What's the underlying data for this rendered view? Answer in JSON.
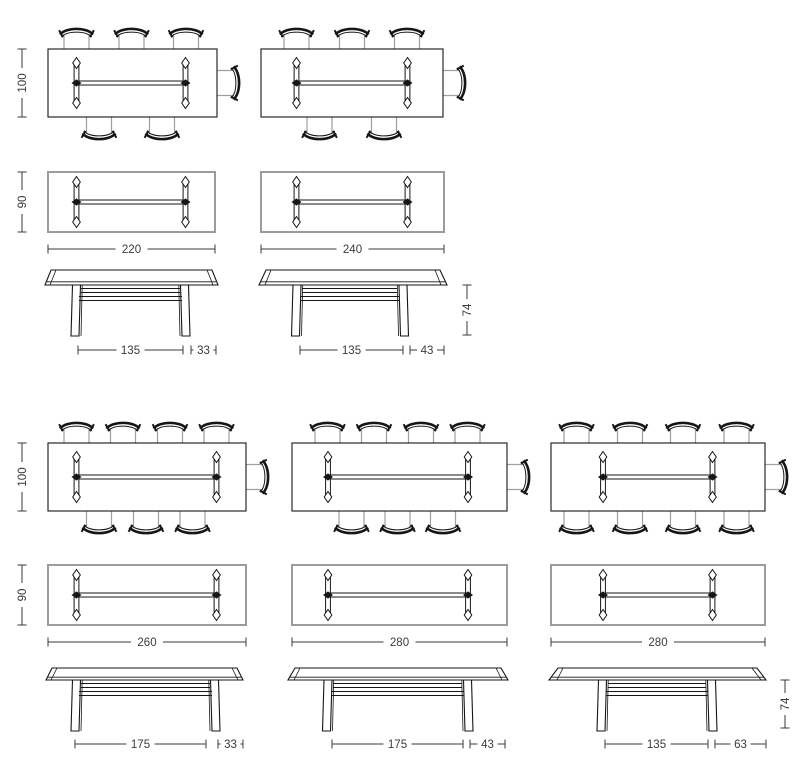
{
  "drawing_kind": "dining-table dimension drawings (plan with chairs, plan, side elevation)",
  "colors": {
    "background": "#ffffff",
    "line": "#161616",
    "muted_line": "#9aa0a4",
    "plain_top_border": "#9c9c9c",
    "dimension": "#3a3a3a"
  },
  "figures": [
    {
      "name": "table-220",
      "plan_chairs": {
        "depth_label": "100",
        "chairs_top": 3,
        "chairs_bottom": 2,
        "chairs_end": 1
      },
      "plan_top": {
        "depth_label": "90",
        "width_label": "220"
      },
      "elevation": {
        "leg_span_label": "135",
        "overhang_label": "33"
      }
    },
    {
      "name": "table-240",
      "plan_chairs": {
        "chairs_top": 3,
        "chairs_bottom": 2,
        "chairs_end": 1
      },
      "plan_top": {
        "width_label": "240"
      },
      "elevation": {
        "leg_span_label": "135",
        "overhang_label": "43",
        "height_label": "74"
      }
    },
    {
      "name": "table-260",
      "plan_chairs": {
        "depth_label": "100",
        "chairs_top": 4,
        "chairs_bottom": 3,
        "chairs_end": 1
      },
      "plan_top": {
        "depth_label": "90",
        "width_label": "260"
      },
      "elevation": {
        "leg_span_label": "175",
        "overhang_label": "33"
      }
    },
    {
      "name": "table-280",
      "plan_chairs": {
        "chairs_top": 4,
        "chairs_bottom": 3,
        "chairs_end": 1
      },
      "plan_top": {
        "width_label": "280"
      },
      "elevation": {
        "leg_span_label": "175",
        "overhang_label": "43"
      }
    },
    {
      "name": "table-280-long-overhang",
      "plan_chairs": {
        "chairs_top": 4,
        "chairs_bottom": 4,
        "chairs_end": 1
      },
      "plan_top": {
        "width_label": "280"
      },
      "elevation": {
        "leg_span_label": "135",
        "overhang_label": "63",
        "height_label": "74"
      }
    }
  ]
}
